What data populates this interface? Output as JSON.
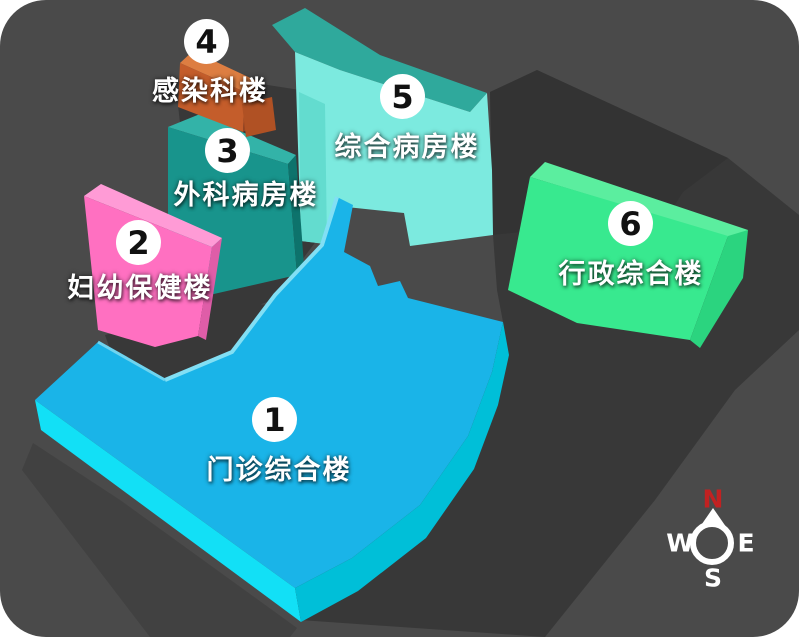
{
  "map": {
    "background_color": "#4a4a4a",
    "shadow_color": "#383838",
    "buildings": [
      {
        "number": "1",
        "name": "门诊综合楼",
        "color": "#1ab4e8"
      },
      {
        "number": "2",
        "name": "妇幼保健楼",
        "color": "#ff70c1"
      },
      {
        "number": "3",
        "name": "外科病房楼",
        "color": "#18948c"
      },
      {
        "number": "4",
        "name": "感染科楼",
        "color": "#c45d2b"
      },
      {
        "number": "5",
        "name": "综合病房楼",
        "color": "#7ceadf"
      },
      {
        "number": "6",
        "name": "行政综合楼",
        "color": "#38e98f"
      }
    ],
    "badge": {
      "background": "#ffffff",
      "text_color": "#111111"
    },
    "label_color": "#ffffff",
    "compass": {
      "north": "N",
      "west": "W",
      "east": "E",
      "south": "S",
      "north_color": "#c22121",
      "letter_color": "#ffffff"
    }
  }
}
